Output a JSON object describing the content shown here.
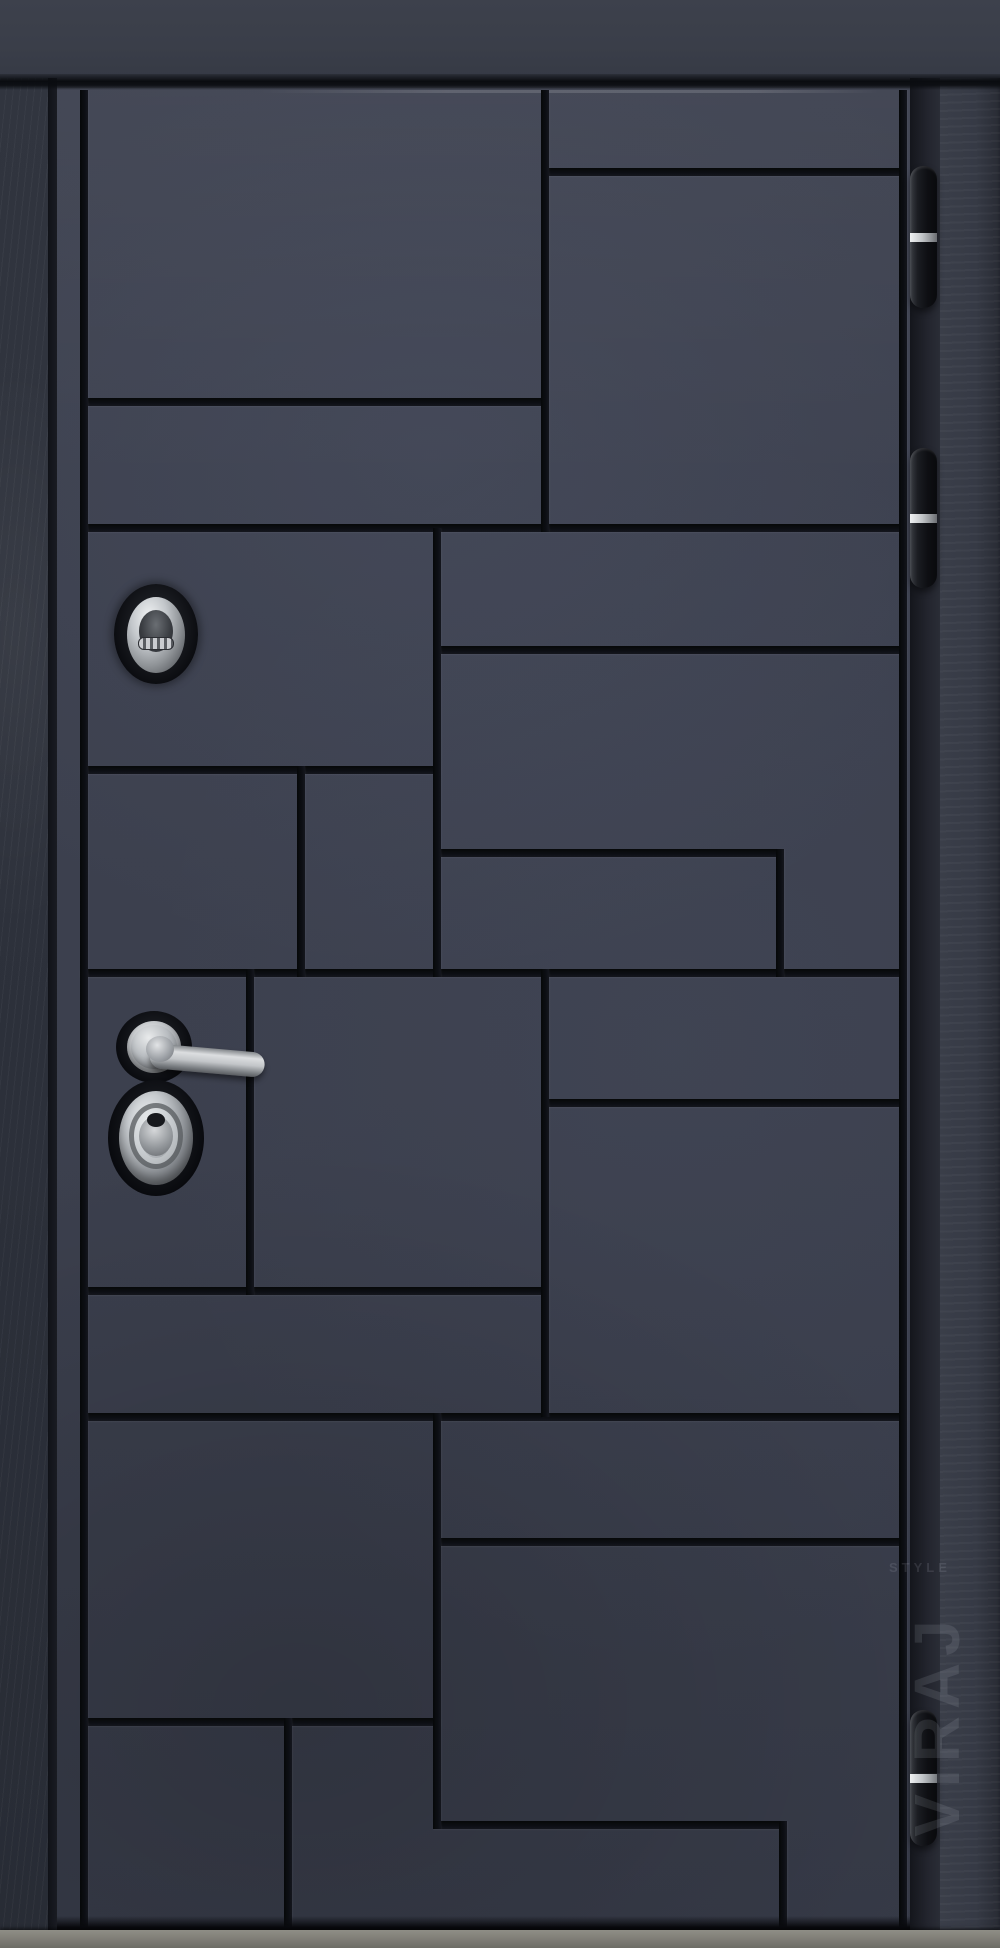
{
  "scene": {
    "subject": "steel entry door, front view, closed",
    "finish": "dark graphite-blue concrete-textured panels with deep black grooves in an offset geometric grid",
    "camera": "straight-on product photo"
  },
  "watermark": {
    "brand": "VIRAJ",
    "sub": "STYLE"
  },
  "palette": {
    "frame": "#3a3e49",
    "frame_side": "#2f333e",
    "leaf_panel": "#3c404e",
    "groove": "#0c0e13",
    "hinge_body": "#141519",
    "chrome": "#c5c9cd",
    "threshold": "#83827b"
  },
  "leaf": {
    "x": 57,
    "y": 88,
    "w": 853,
    "h": 1842
  },
  "grooves": {
    "thickness": 8,
    "horizontal": [
      {
        "x": 541,
        "y": 168,
        "len": 366
      },
      {
        "x": 80,
        "y": 398,
        "len": 469
      },
      {
        "x": 80,
        "y": 524,
        "len": 827
      },
      {
        "x": 433,
        "y": 646,
        "len": 474
      },
      {
        "x": 80,
        "y": 766,
        "len": 361
      },
      {
        "x": 433,
        "y": 849,
        "len": 351
      },
      {
        "x": 80,
        "y": 969,
        "len": 827
      },
      {
        "x": 541,
        "y": 1099,
        "len": 366
      },
      {
        "x": 80,
        "y": 1287,
        "len": 469
      },
      {
        "x": 80,
        "y": 1413,
        "len": 827
      },
      {
        "x": 433,
        "y": 1538,
        "len": 474
      },
      {
        "x": 80,
        "y": 1718,
        "len": 361
      },
      {
        "x": 433,
        "y": 1821,
        "len": 354
      }
    ],
    "vertical": [
      {
        "x": 80,
        "y": 90,
        "len": 1840
      },
      {
        "x": 899,
        "y": 90,
        "len": 1840
      },
      {
        "x": 541,
        "y": 90,
        "len": 442
      },
      {
        "x": 541,
        "y": 969,
        "len": 448
      },
      {
        "x": 433,
        "y": 528,
        "len": 449
      },
      {
        "x": 433,
        "y": 1413,
        "len": 416
      },
      {
        "x": 297,
        "y": 766,
        "len": 211
      },
      {
        "x": 246,
        "y": 969,
        "len": 326
      },
      {
        "x": 776,
        "y": 849,
        "len": 128
      },
      {
        "x": 779,
        "y": 1821,
        "len": 109
      },
      {
        "x": 284,
        "y": 1718,
        "len": 212
      }
    ]
  },
  "hardware": {
    "top_cylinder": {
      "cx": 156,
      "cy": 634,
      "style": "chrome oval escutcheon with ribbed key flap"
    },
    "handle": {
      "cx": 154,
      "cy": 1047,
      "style": "chrome lever on round rose, pointing right"
    },
    "deadbolt": {
      "cx": 156,
      "cy": 1138,
      "style": "large chrome oval cylinder with concentric rings"
    },
    "hinges": {
      "x": 910,
      "w": 27,
      "ring_ratio": 0.5,
      "items": [
        {
          "y": 166,
          "h": 142
        },
        {
          "y": 448,
          "h": 140
        },
        {
          "y": 1710,
          "h": 136
        }
      ]
    }
  },
  "threshold": {
    "y": 1930,
    "h": 18
  }
}
